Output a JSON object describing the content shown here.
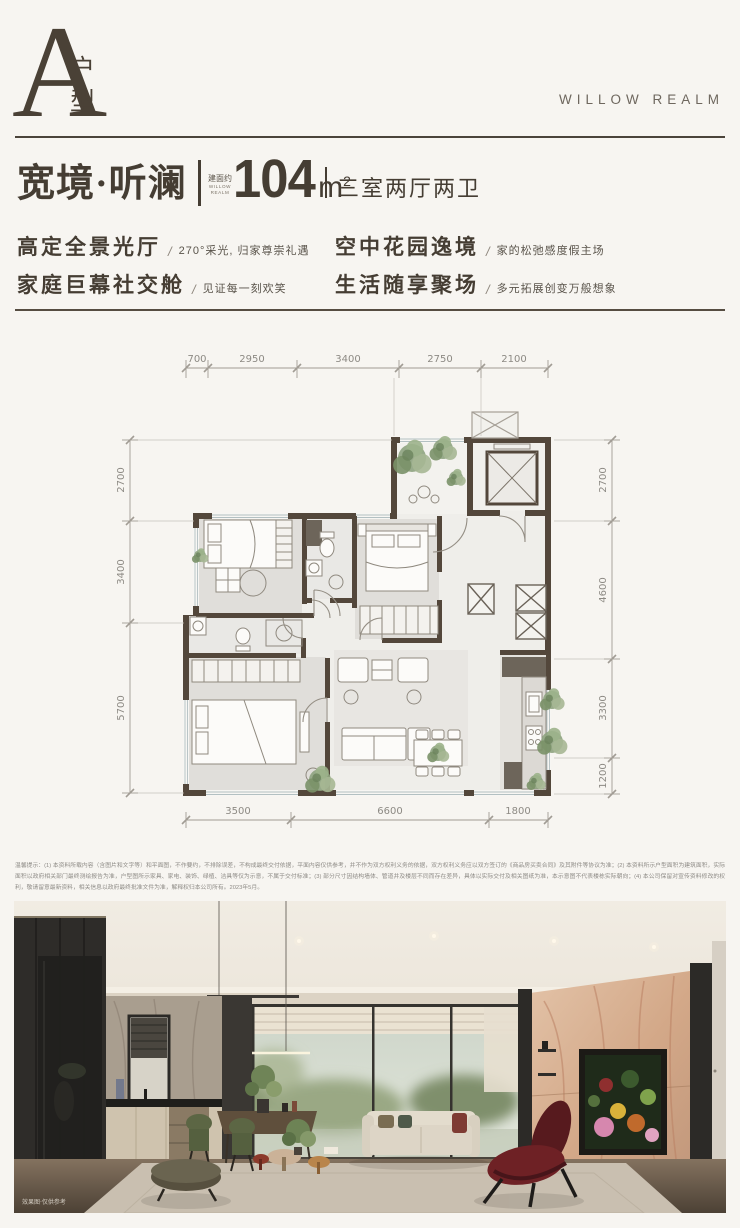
{
  "brand": {
    "logo": "WILLOW REALM"
  },
  "header": {
    "unit_letter": "A",
    "unit_char_1": "户",
    "unit_char_2": "型"
  },
  "title_bar": {
    "name": "宽境·听澜",
    "area_prefix": "建面约",
    "area_en_1": "WILLOW",
    "area_en_2": "REALM",
    "area_value": "104",
    "area_unit": "m",
    "area_exponent": "2",
    "layout": "三室两厅两卫"
  },
  "feature_separator": "/",
  "features": [
    {
      "title": "高定全景光厅",
      "desc": "270°采光, 归家尊崇礼遇"
    },
    {
      "title": "空中花园逸境",
      "desc": "家的松弛感度假主场"
    },
    {
      "title": "家庭巨幕社交舱",
      "desc": "见证每一刻欢笑"
    },
    {
      "title": "生活随享聚场",
      "desc": "多元拓展创变万般想象"
    }
  ],
  "floorplan": {
    "dims_top": [
      "700",
      "2950",
      "3400",
      "2750",
      "2100"
    ],
    "dims_left": [
      "2700",
      "3400",
      "5700"
    ],
    "dims_right": [
      "2700",
      "4600",
      "3300",
      "1200"
    ],
    "dims_bottom": [
      "3500",
      "6600",
      "1800"
    ]
  },
  "disclaimer": "温馨提示：(1) 本资料所载内容（含图片和文字等）和平面图，不作要约，不排除误差，不构成最终交付依据，平面内容仅供参考，并不作为双方权利义务的依据，双方权利义务应以双方签订的《商品房买卖合同》及其附件等协议为准；(2) 本资料所示户型面积为建筑面积，实际面积以政府相关部门最终测绘报告为准，户型图所示家具、家电、装饰、绿植、洁具等仅为示意，不属于交付标准；(3) 部分尺寸因结构墙体、管道井及楼层不同而存在差异，具体以实际交付及相关图纸为准，本示意图不代表楼栋实际朝向；(4) 本公司保留对宣传资料修改的权利，敬请留意最新资料，相关信息以政府最终批准文件为准，解释权归本公司所有。2023年5月。",
  "photo": {
    "caption": "效果图·仅供参考"
  },
  "colors": {
    "ink": "#453d33",
    "wall": "#53473b",
    "dim_line": "#a19c94",
    "background": "#f7f5f1"
  }
}
